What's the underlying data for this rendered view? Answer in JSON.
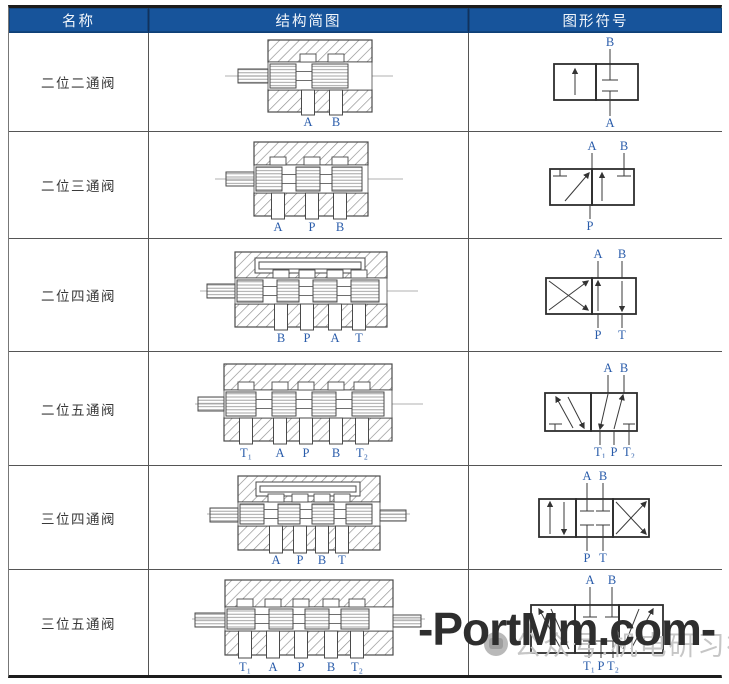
{
  "header": {
    "columns": [
      "名称",
      "结构简图",
      "图形符号"
    ]
  },
  "rows": [
    {
      "name": "二位二通阀",
      "structure": {
        "ports": [
          "A",
          "B"
        ]
      },
      "symbol": {
        "top_ports": [
          "B"
        ],
        "bottom_ports": [
          "A"
        ]
      }
    },
    {
      "name": "二位三通阀",
      "structure": {
        "ports": [
          "A",
          "P",
          "B"
        ]
      },
      "symbol": {
        "top_ports": [
          "A",
          "B"
        ],
        "bottom_ports": [
          "P"
        ]
      }
    },
    {
      "name": "二位四通阀",
      "structure": {
        "ports": [
          "B",
          "P",
          "A",
          "T"
        ]
      },
      "symbol": {
        "top_ports": [
          "A",
          "B"
        ],
        "bottom_ports": [
          "P",
          "T"
        ]
      }
    },
    {
      "name": "二位五通阀",
      "structure": {
        "ports": [
          "T₁",
          "A",
          "P",
          "B",
          "T₂"
        ]
      },
      "symbol": {
        "top_ports": [
          "A",
          "B"
        ],
        "bottom_ports": [
          "T₁",
          "P",
          "T₂"
        ]
      }
    },
    {
      "name": "三位四通阀",
      "structure": {
        "ports": [
          "A",
          "P",
          "B",
          "T"
        ]
      },
      "symbol": {
        "top_ports": [
          "A",
          "B"
        ],
        "bottom_ports": [
          "P",
          "T"
        ]
      }
    },
    {
      "name": "三位五通阀",
      "structure": {
        "ports": [
          "T₁",
          "A",
          "P",
          "B",
          "T₂"
        ]
      },
      "symbol": {
        "top_ports": [
          "A",
          "B"
        ],
        "bottom_ports": [
          "T₁",
          "P",
          "T₂"
        ]
      }
    }
  ],
  "watermark": {
    "main": "-PortMm.com-",
    "badge": "公众号:机电研习社"
  },
  "colors": {
    "header_bg": "#17549B",
    "header_text": "#F2F6FB",
    "port_label": "#2A5CAA",
    "diagram_line": "#4A4A4A",
    "watermark_main": "#2E2E2E",
    "watermark_badge": "#C6C6C6"
  }
}
